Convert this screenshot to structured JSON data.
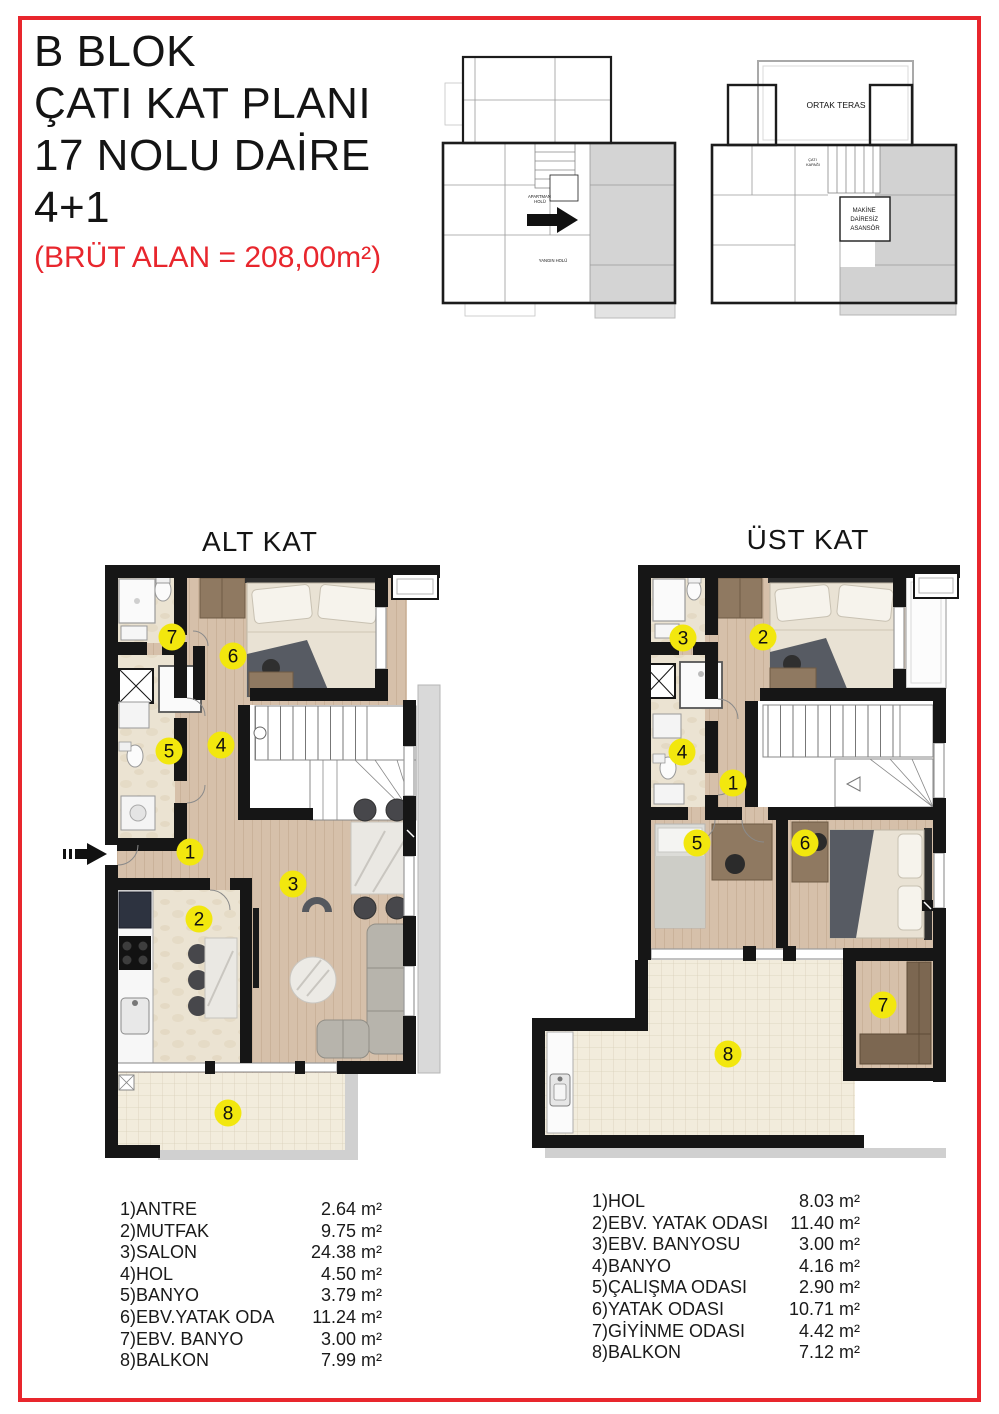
{
  "colors": {
    "accent_red": "#e8262d",
    "marker_yellow": "#f2e70e",
    "wall_black": "#161616",
    "wood_floor": "#d6c0aa",
    "bath_marble": "#ebe3d2",
    "balcony_tile": "#f2ecdc",
    "exterior_gray": "#d9d9d9"
  },
  "title": {
    "lines": [
      "B BLOK",
      "ÇATI KAT PLANI",
      "17 NOLU DAİRE",
      "4+1"
    ],
    "area_note": "(BRÜT ALAN = 208,00m²)"
  },
  "key_plans": {
    "left": {
      "apartman_holu_lines": [
        "APARTMAN",
        "HOLÜ"
      ],
      "yangin_holu": "YANGIN HOLÜ"
    },
    "right": {
      "ortak_teras": "ORTAK TERAS",
      "asansor_lines": [
        "MAKİNE",
        "DAİRESİZ",
        "ASANSÖR"
      ],
      "cati_kapagi_lines": [
        "ÇATI",
        "KAPAĞI"
      ]
    }
  },
  "plans": {
    "alt": {
      "heading": "ALT KAT",
      "markers": [
        "1",
        "2",
        "3",
        "4",
        "5",
        "6",
        "7",
        "8"
      ]
    },
    "ust": {
      "heading": "ÜST KAT",
      "markers": [
        "1",
        "2",
        "3",
        "4",
        "5",
        "6",
        "7",
        "8"
      ]
    }
  },
  "legend_alt": {
    "items": [
      {
        "label": "1)ANTRE",
        "area": "2.64 m²"
      },
      {
        "label": "2)MUTFAK",
        "area": "9.75 m²"
      },
      {
        "label": "3)SALON",
        "area": "24.38 m²"
      },
      {
        "label": "4)HOL",
        "area": "4.50 m²"
      },
      {
        "label": "5)BANYO",
        "area": "3.79 m²"
      },
      {
        "label": "6)EBV.YATAK ODA",
        "area": "11.24 m²"
      },
      {
        "label": "7)EBV. BANYO",
        "area": "3.00 m²"
      },
      {
        "label": "8)BALKON",
        "area": "7.99 m²"
      }
    ]
  },
  "legend_ust": {
    "items": [
      {
        "label": "1)HOL",
        "area": "8.03 m²"
      },
      {
        "label": "2)EBV. YATAK ODASI",
        "area": "11.40 m²"
      },
      {
        "label": "3)EBV. BANYOSU",
        "area": "3.00 m²"
      },
      {
        "label": "4)BANYO",
        "area": "4.16 m²"
      },
      {
        "label": "5)ÇALIŞMA ODASI",
        "area": "2.90 m²"
      },
      {
        "label": "6)YATAK ODASI",
        "area": "10.71 m²"
      },
      {
        "label": "7)GİYİNME ODASI",
        "area": "4.42 m²"
      },
      {
        "label": "8)BALKON",
        "area": "7.12 m²"
      }
    ]
  }
}
